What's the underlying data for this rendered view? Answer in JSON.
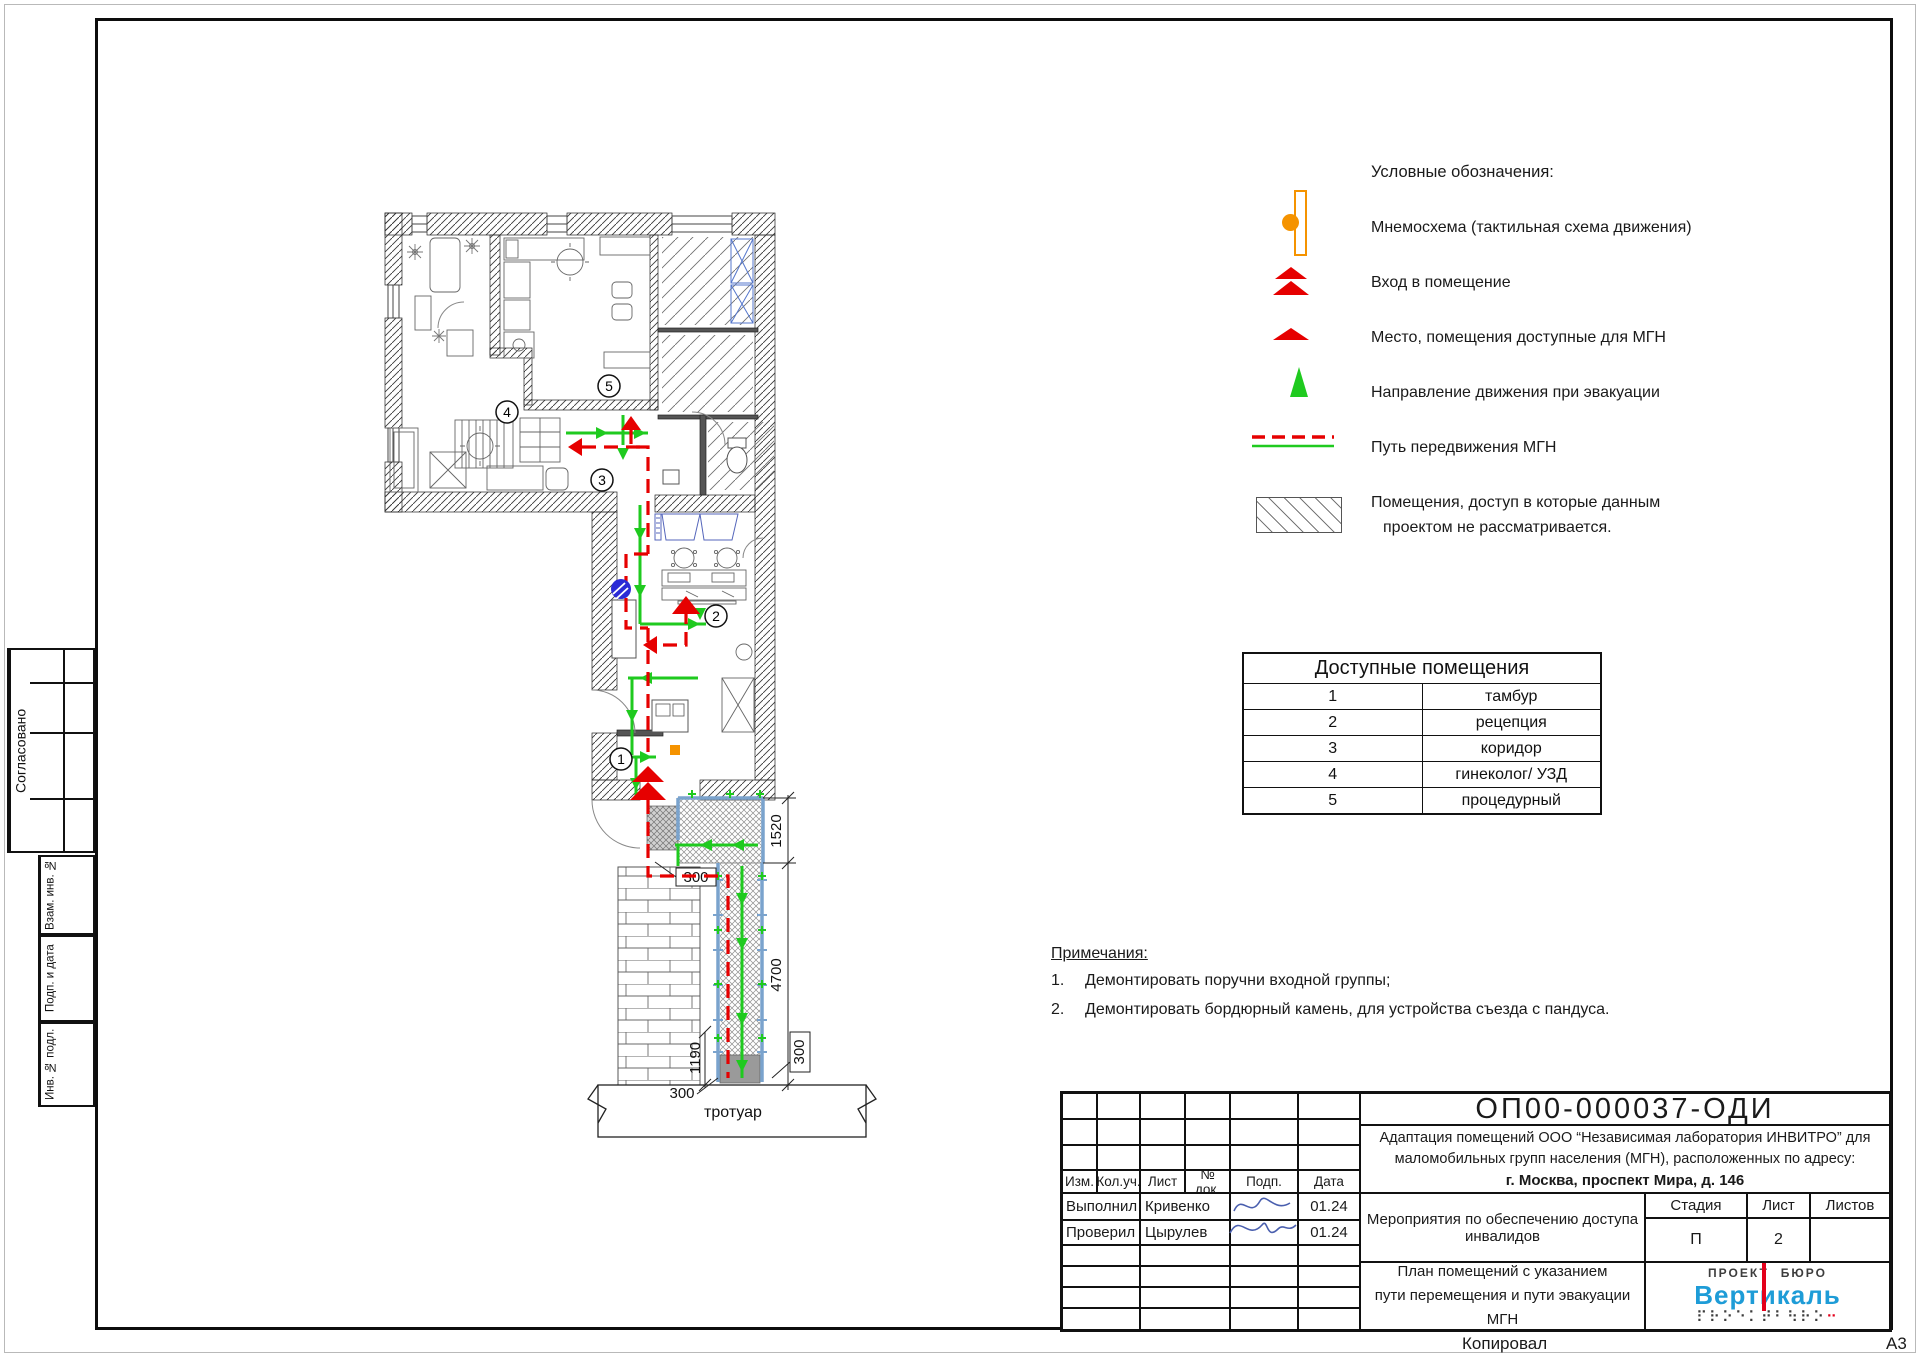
{
  "colors": {
    "path_red": "#e60000",
    "path_green": "#1fca1f",
    "rail_blue": "#7aa3cd",
    "symbol_blue": "#2b2bd6",
    "mnemo_orange": "#f59300",
    "logo_blue": "#1e9cd7",
    "logo_red": "#e3001b",
    "signature_ink": "#4a5fae"
  },
  "left_margin": {
    "approved": "Согласовано",
    "stamp_vzam": "Взам. инв. №",
    "stamp_podp": "Подп. и дата",
    "stamp_inv": "Инв. № подл."
  },
  "legend": {
    "title": "Условные обозначения:",
    "items": [
      {
        "symbol": "mnemoscheme",
        "label": "Мнемосхема (тактильная схема движения)"
      },
      {
        "symbol": "entrance",
        "label": "Вход в помещение"
      },
      {
        "symbol": "accessible-place",
        "label": "Место, помещения доступные для МГН"
      },
      {
        "symbol": "evacuation-direction",
        "label": "Направление движения при эвакуации"
      },
      {
        "symbol": "mgn-path",
        "label": "Путь передвижения МГН"
      },
      {
        "symbol": "excluded-rooms",
        "label": "Помещения, доступ в которые данным",
        "label2": "проектом не рассматривается."
      }
    ]
  },
  "rooms_table": {
    "title": "Доступные помещения",
    "rows": [
      {
        "num": "1",
        "name": "тамбур"
      },
      {
        "num": "2",
        "name": "рецепция"
      },
      {
        "num": "3",
        "name": "коридор"
      },
      {
        "num": "4",
        "name": "гинеколог/ УЗД"
      },
      {
        "num": "5",
        "name": "процедурный"
      }
    ]
  },
  "notes": {
    "title": "Примечания:",
    "items": [
      {
        "num": "1.",
        "text": "Демонтировать поручни входной группы;"
      },
      {
        "num": "2.",
        "text": "Демонтировать бордюрный камень, для устройства съезда с пандуса."
      }
    ]
  },
  "plan": {
    "rooms": [
      "1",
      "2",
      "3",
      "4",
      "5"
    ],
    "dims": {
      "d1520": "1520",
      "d300_step": "300",
      "d4700": "4700",
      "d1190": "1190",
      "d300_right": "300",
      "d300_bottom": "300"
    },
    "sidewalk": "тротуар"
  },
  "title_block": {
    "doc_number": "ОП00-000037-ОДИ",
    "project_line1": "Адаптация помещений ООО “Независимая лаборатория ИНВИТРО” для",
    "project_line2": "маломобильных групп населения (МГН), расположенных по адресу:",
    "project_line3": "г. Москва, проспект Мира, д. 146",
    "columns": [
      "Изм.",
      "Кол.уч.",
      "Лист",
      "№ док.",
      "Подп.",
      "Дата"
    ],
    "row1": {
      "role": "Выполнил",
      "name": "Кривенко",
      "date": "01.24"
    },
    "row2": {
      "role": "Проверил",
      "name": "Цырулев",
      "date": "01.24"
    },
    "section_line1": "Мероприятия по обеспечению доступа",
    "section_line2": "инвалидов",
    "stage_label": "Стадия",
    "sheet_label": "Лист",
    "sheets_label": "Листов",
    "stage_value": "П",
    "sheet_value": "2",
    "sheets_value": "",
    "drawing_line1": "План помещений с указанием",
    "drawing_line2": "пути перемещения и пути эвакуации МГН",
    "logo": {
      "top_left": "ПРОЕКТ",
      "top_right": "БЮРО",
      "name": "Вертикаль",
      "braille": "⠏⠗⠕⠑⠅⠞⠃⠳⠗⠕"
    }
  },
  "footer": {
    "copied": "Копировал",
    "format": "А3"
  }
}
